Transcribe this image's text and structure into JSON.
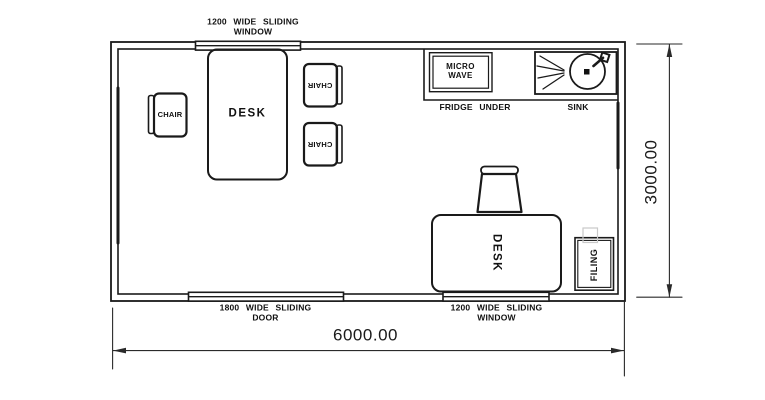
{
  "labels": {
    "top_window": {
      "line1": "1200 WIDE SLIDING",
      "line2": "WINDOW"
    },
    "microwave": {
      "line1": "MICRO",
      "line2": "WAVE"
    },
    "fridge": "FRIDGE UNDER",
    "sink": "SINK",
    "chair": "CHAIR",
    "desk": "DESK",
    "filing": "FILING",
    "door": {
      "line1": "1800 WIDE SLIDING",
      "line2": "DOOR"
    },
    "bottom_window": {
      "line1": "1200 WIDE SLIDING",
      "line2": "WINDOW"
    }
  },
  "dimensions": {
    "width": "6000.00",
    "height": "3000.00"
  },
  "colors": {
    "line": "#1a1a1a",
    "dimension": "#2a2a2a",
    "background": "#ffffff",
    "artifact": "#c9c9c9"
  }
}
